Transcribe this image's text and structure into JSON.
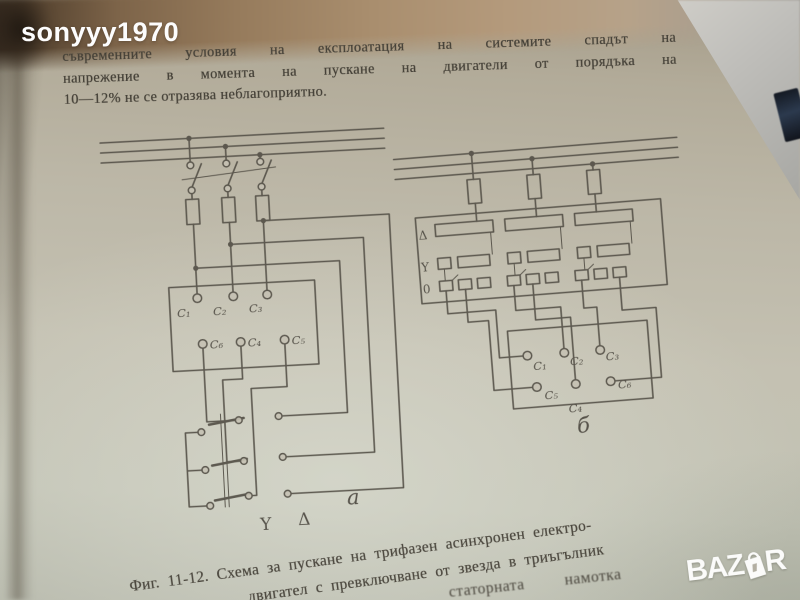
{
  "watermarks": {
    "username": "sonyyy1970",
    "site_logo_left": "BAZ",
    "site_logo_right": "R"
  },
  "page": {
    "paragraph": {
      "line1": "съвременните условия на експлоатация на системите спадът на",
      "line2": "напрежение в момента на пускане на двигатели от порядъка на",
      "line3": "10—12% не се отразява неблагоприятно."
    },
    "caption": {
      "line1": "Фиг. 11-12. Схема за пускане на трифазен асинхронен електро-",
      "line2": "двигател с превключване от звезда в триъгълник",
      "partial_next_text": "статорната намотка"
    },
    "figure": {
      "diagram_a": {
        "label": "а",
        "terminals_top": [
          "C₁",
          "C₂",
          "C₃"
        ],
        "terminals_bottom": [
          "C₆",
          "C₄",
          "C₅"
        ],
        "star_label": "Y",
        "delta_label": "Δ"
      },
      "diagram_b": {
        "label": "б",
        "row_labels": [
          "Δ",
          "Y",
          "0"
        ],
        "terminals_top": [
          "C₁",
          "C₂",
          "C₃"
        ],
        "terminals_bottom": [
          "C₅",
          "C₄",
          "C₆"
        ]
      }
    }
  },
  "colors": {
    "ink": "#555148",
    "page": "#c1bdae",
    "watermark": "#ffffff"
  }
}
